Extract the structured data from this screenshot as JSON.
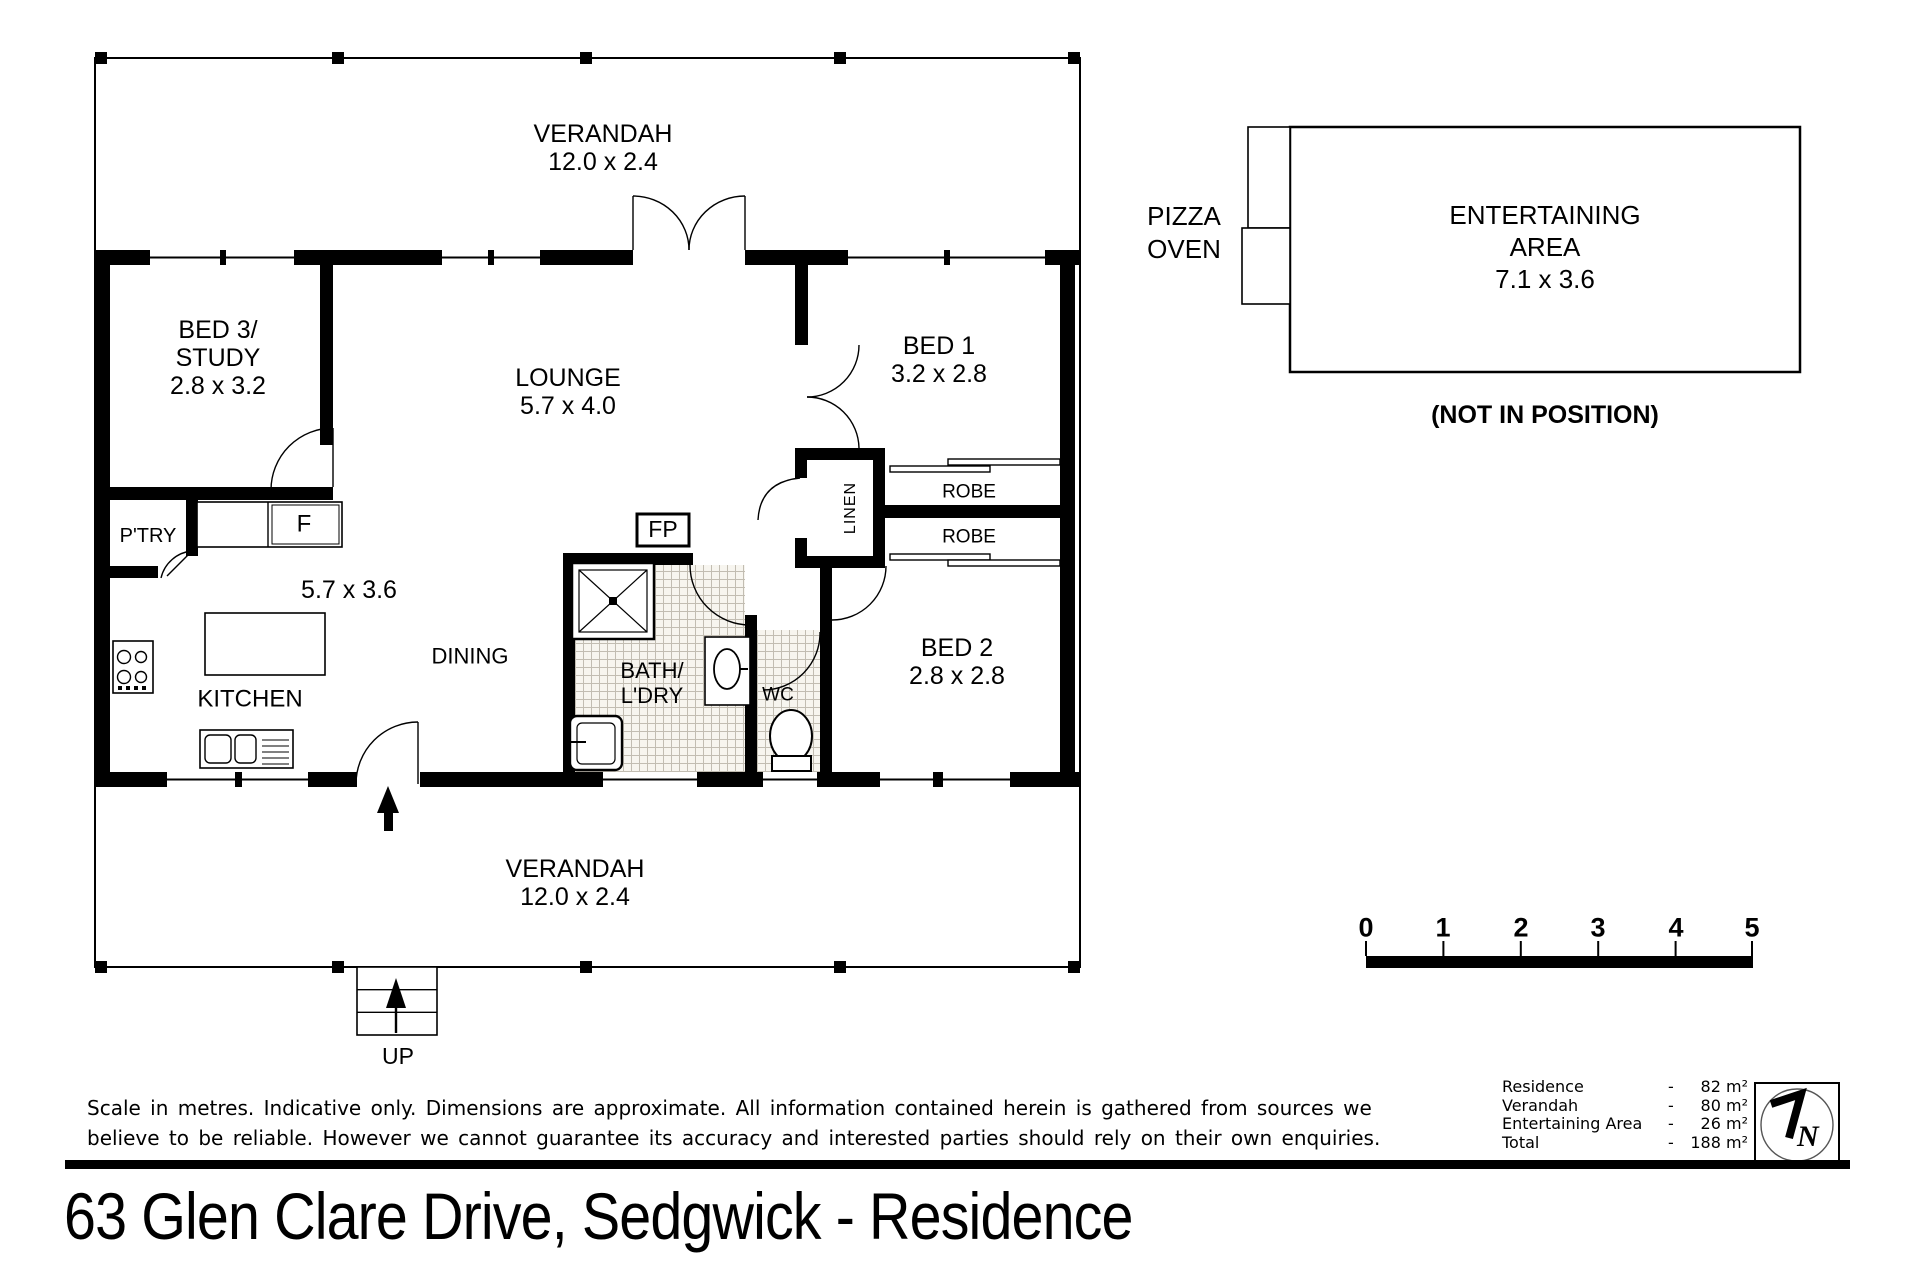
{
  "title": "63 Glen Clare Drive, Sedgwick - Residence",
  "plan": {
    "verandah_top": {
      "name": "VERANDAH",
      "dims": "12.0 x 2.4"
    },
    "bed3": {
      "line1": "BED 3/",
      "line2": "STUDY",
      "dims": "2.8 x 3.2"
    },
    "lounge": {
      "name": "LOUNGE",
      "dims": "5.7 x 4.0"
    },
    "bed1": {
      "name": "BED 1",
      "dims": "3.2 x 2.8"
    },
    "robe1": "ROBE",
    "robe2": "ROBE",
    "linen": "LINEN",
    "pantry": "P'TRY",
    "fridge": "F",
    "fireplace": "FP",
    "kitchen_dims": "5.7 x 3.6",
    "dining": "DINING",
    "kitchen": "KITCHEN",
    "bath": {
      "line1": "BATH/",
      "line2": "L'DRY"
    },
    "wc": "WC",
    "bed2": {
      "name": "BED 2",
      "dims": "2.8 x 2.8"
    },
    "verandah_bottom": {
      "name": "VERANDAH",
      "dims": "12.0 x 2.4"
    },
    "up": "UP"
  },
  "outbuilding": {
    "pizza_line1": "PIZZA",
    "pizza_line2": "OVEN",
    "ent_line1": "ENTERTAINING",
    "ent_line2": "AREA",
    "ent_dims": "7.1 x 3.6",
    "note": "(NOT IN POSITION)"
  },
  "scale_bar": {
    "ticks": [
      "0",
      "1",
      "2",
      "3",
      "4",
      "5"
    ]
  },
  "disclaimer": {
    "line1": "Scale in metres. Indicative only. Dimensions are approximate.  All information contained herein is gathered from sources we",
    "line2": "believe to be reliable. However we cannot guarantee its accuracy and interested parties should rely on their own enquiries."
  },
  "areas": {
    "rows": [
      {
        "label": "Residence",
        "dash": "-",
        "value": "82 m²"
      },
      {
        "label": "Verandah",
        "dash": "-",
        "value": "80 m²"
      },
      {
        "label": "Entertaining Area",
        "dash": "-",
        "value": "26 m²"
      },
      {
        "label": "Total",
        "dash": "-",
        "value": "188 m²"
      }
    ]
  },
  "colors": {
    "wall": "#000000",
    "paper": "#ffffff",
    "tile_line": "#c2bdb2"
  }
}
